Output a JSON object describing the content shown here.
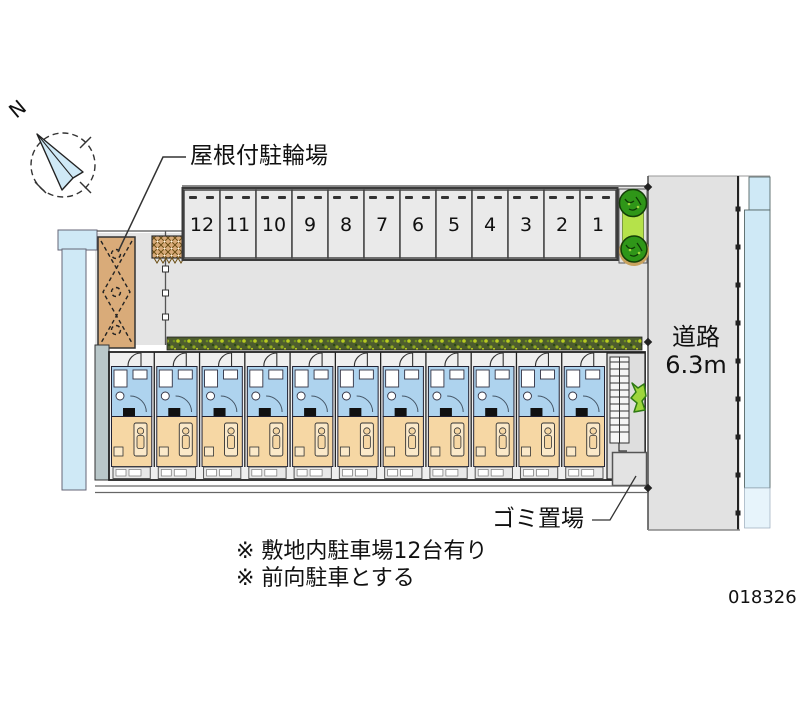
{
  "labels": {
    "north": "N",
    "bicycle_parking": "屋根付駐輪場",
    "road_line1": "道路",
    "road_line2": "6.3m",
    "garbage": "ゴミ置場",
    "note1": "※ 敷地内駐車場12台有り",
    "note2": "※ 前向駐車とする",
    "plan_number": "018326"
  },
  "parking": {
    "stalls": [
      "12",
      "11",
      "10",
      "9",
      "8",
      "7",
      "6",
      "5",
      "4",
      "3",
      "2",
      "1"
    ]
  },
  "building": {
    "unit_count": 11
  },
  "colors": {
    "ground": "#e4e4e4",
    "road": "#e2e2e2",
    "water": "#cfe9f6",
    "water_light": "#e7f4fb",
    "stall": "#eaeaea",
    "unit_blue": "#aed3ee",
    "unit_orange": "#f6d7a4",
    "bed": "#fbe9c9",
    "bike_area": "#d9ab79",
    "hedge_base": "#4d5c2e",
    "bush": "#2f9618",
    "bush_light": "#9ed63c",
    "line": "#333333",
    "text": "#111111"
  }
}
